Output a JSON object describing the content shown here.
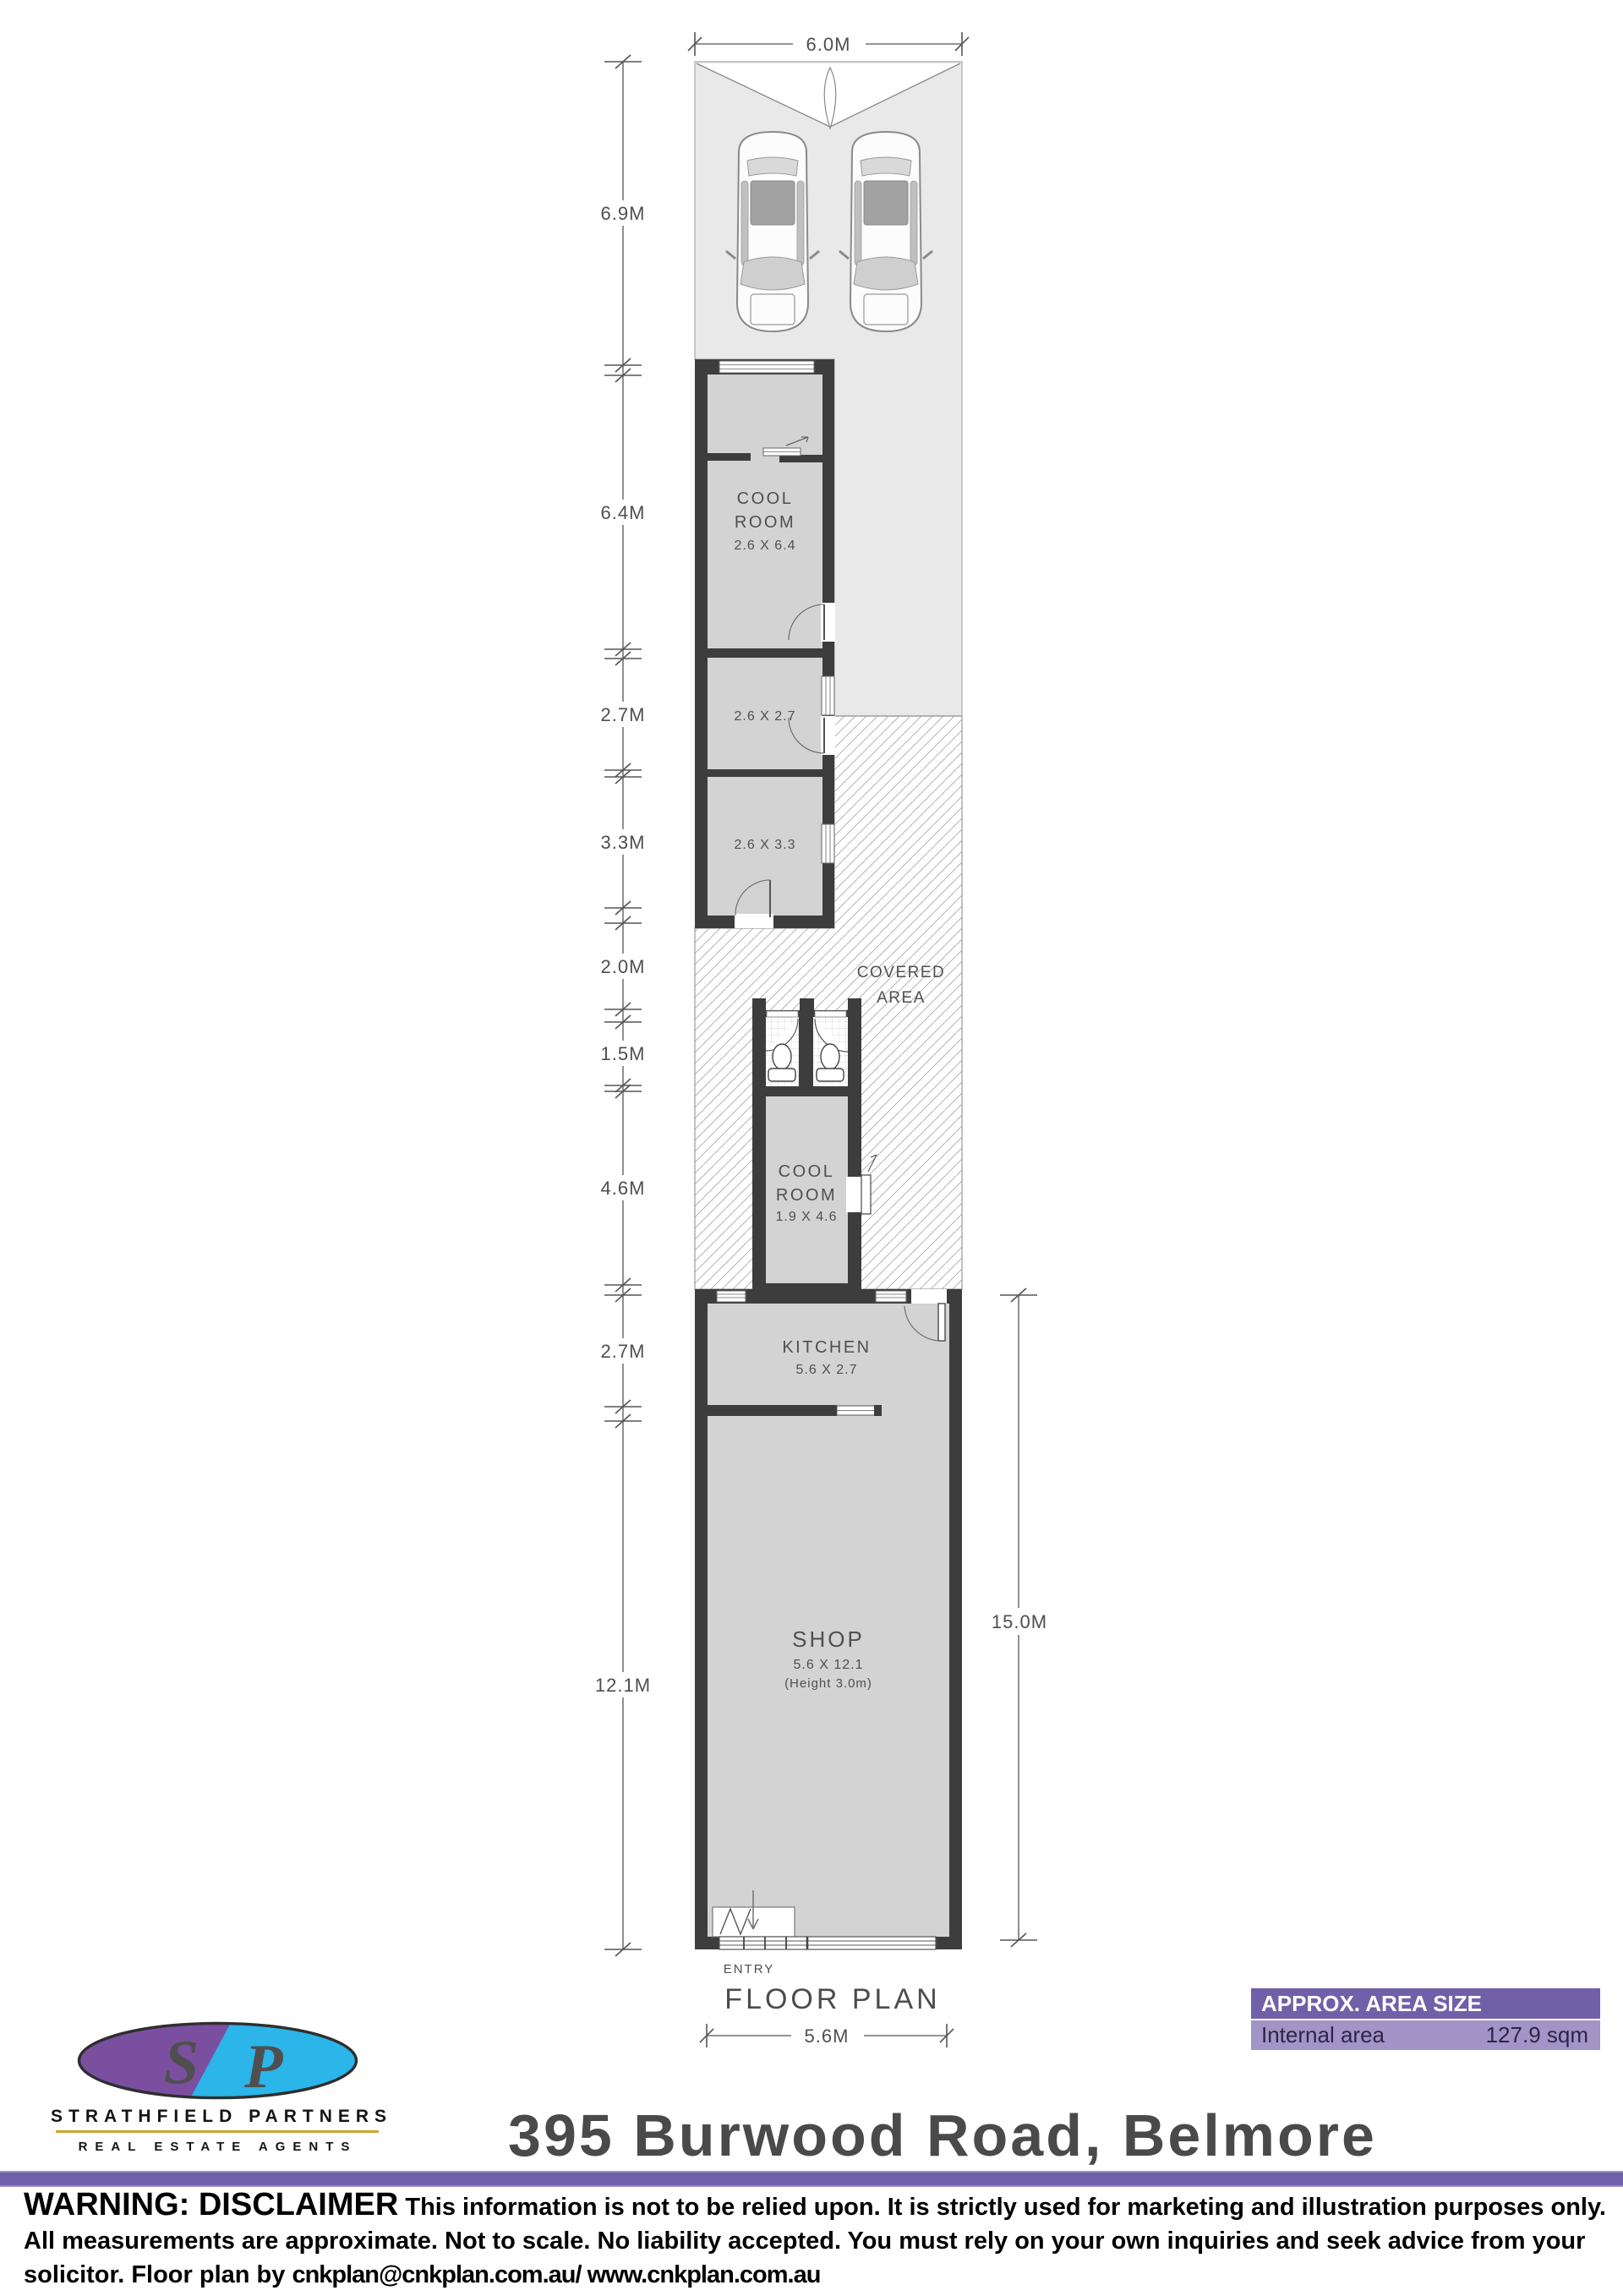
{
  "plan": {
    "title": "FLOOR PLAN",
    "entry_label": "ENTRY",
    "dims": {
      "top": "6.0M",
      "bottom": "5.6M",
      "right": "15.0M",
      "left": [
        "6.9M",
        "6.4M",
        "2.7M",
        "3.3M",
        "2.0M",
        "1.5M",
        "4.6M",
        "2.7M",
        "12.1M"
      ]
    },
    "rooms": {
      "cool1": {
        "l1": "COOL",
        "l2": "ROOM",
        "size": "2.6 X 6.4"
      },
      "store1": {
        "size": "2.6 X 2.7"
      },
      "store2": {
        "size": "2.6 X 3.3"
      },
      "covered": {
        "l1": "COVERED",
        "l2": "AREA"
      },
      "cool2": {
        "l1": "COOL",
        "l2": "ROOM",
        "size": "1.9 X 4.6"
      },
      "kitchen": {
        "name": "KITCHEN",
        "size": "5.6 X 2.7"
      },
      "shop": {
        "name": "SHOP",
        "size": "5.6 X 12.1",
        "note": "(Height 3.0m)"
      }
    }
  },
  "area_box": {
    "header": "APPROX. AREA SIZE",
    "label": "Internal area",
    "value": "127.9 sqm"
  },
  "logo": {
    "s": "S",
    "p": "P",
    "name": "STRATHFIELD PARTNERS",
    "tagline": "REAL ESTATE AGENTS"
  },
  "address_title": "395 Burwood Road, Belmore",
  "disclaimer": {
    "warning": "WARNING: DISCLAIMER",
    "line1": "This information is not to be relied upon. It is strictly used for marketing and illustration purposes only.",
    "line2": "All measurements are approximate. Not to scale. No liability accepted. You must rely on your own inquiries and seek advice from your",
    "line3a": "solicitor. Floor plan by ",
    "line3b": "cnkplan@cnkplan.com.au/ www.cnkplan.com.au"
  },
  "colors": {
    "wall": "#3d3d3d",
    "room_fill": "#d3d3d3",
    "site_fill": "#e9e9e9",
    "accent_purple": "#6f61ab",
    "area_box_header": "#7060aa",
    "area_box_body": "#a294c6",
    "logo_purple": "#7b4fa0",
    "logo_cyan": "#2bb5e8",
    "gold_rule": "#d0a42c"
  }
}
